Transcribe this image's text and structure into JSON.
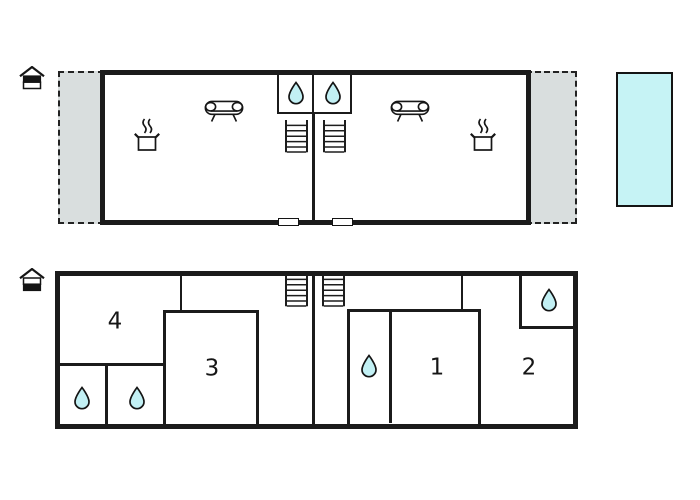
{
  "document": {
    "type": "holiday-home floor plan",
    "floors": 2
  },
  "colors": {
    "wall": "#1b1b1b",
    "terrace_fill": "#d9dede",
    "pool_fill": "#c6f3f5",
    "drop_fill": "#c2f0f4",
    "background": "#ffffff"
  },
  "icons": {
    "water_drop": "water-drop-icon",
    "sofa": "sofa-icon",
    "cooking_pot": "cooking-pot-icon",
    "stairs": "stairs-icon",
    "house_upper": "house-upper-level-icon",
    "house_ground": "house-ground-level-icon"
  },
  "upper_floor": {
    "level_indicator": "upper",
    "terraces": [
      "left",
      "right"
    ],
    "units_mirrored": 2,
    "sofas": 2,
    "cooking_pots": 2,
    "bathroom_drops": 2,
    "stairs": 2,
    "doors": 2,
    "pool": 1
  },
  "ground_floor": {
    "level_indicator": "ground",
    "room_labels": {
      "r1": "1",
      "r2": "2",
      "r3": "3",
      "r4": "4"
    },
    "water_drops": 4,
    "stairs": 2
  }
}
